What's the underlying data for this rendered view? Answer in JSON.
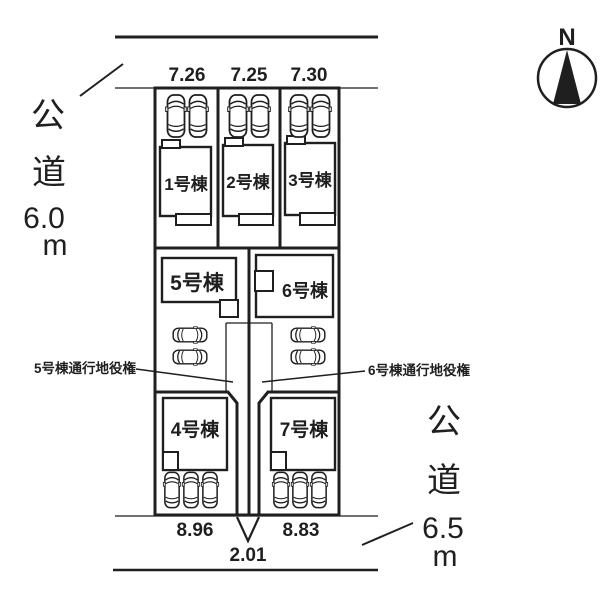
{
  "compass": {
    "label": "N"
  },
  "roads": {
    "left": {
      "name_chars": [
        "公",
        "道"
      ],
      "size": "6.0",
      "unit": "m"
    },
    "right": {
      "name_chars": [
        "公",
        "道"
      ],
      "size": "6.5",
      "unit": "m"
    }
  },
  "dimensions": {
    "top": [
      "7.26",
      "7.25",
      "7.30"
    ],
    "bottom_left": "8.96",
    "bottom_center": "2.01",
    "bottom_right": "8.83"
  },
  "buildings": [
    {
      "label": "1号棟"
    },
    {
      "label": "2号棟"
    },
    {
      "label": "3号棟"
    },
    {
      "label": "4号棟"
    },
    {
      "label": "5号棟"
    },
    {
      "label": "6号棟"
    },
    {
      "label": "7号棟"
    }
  ],
  "easements": {
    "left": "5号棟通行地役権",
    "right": "6号棟通行地役権"
  },
  "colors": {
    "line": "#1f1f1f",
    "background": "#ffffff"
  }
}
